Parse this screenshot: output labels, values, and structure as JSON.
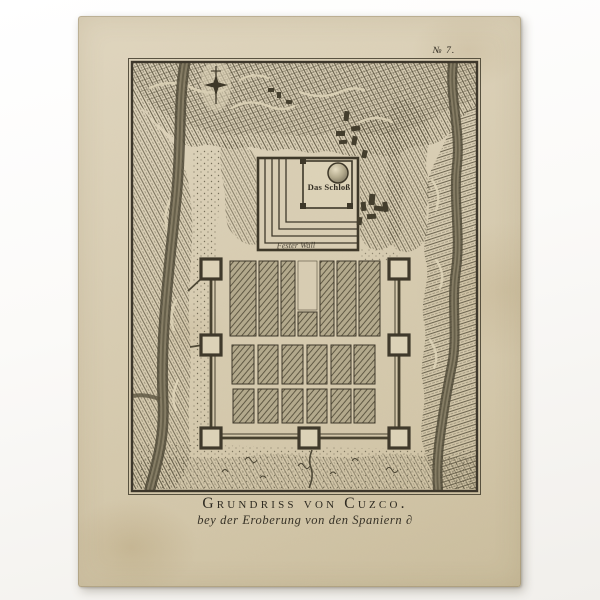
{
  "print": {
    "plate_number": "№ 7.",
    "title": "Grundriss von Cuzco.",
    "subtitle": "bey der Eroberung von den Spaniern ∂",
    "labels": {
      "fortress": "Das Schloß",
      "fortress_wall": "Fester Wall"
    },
    "colors": {
      "photo_background": "#fbfaf8",
      "paper": "#d9ceb4",
      "paper_edge": "#cabd9d",
      "ink_dark": "#3b352a",
      "ink_hatch": "#57503c",
      "block_fill": "#b3a98c",
      "river": "#6a6350"
    }
  }
}
